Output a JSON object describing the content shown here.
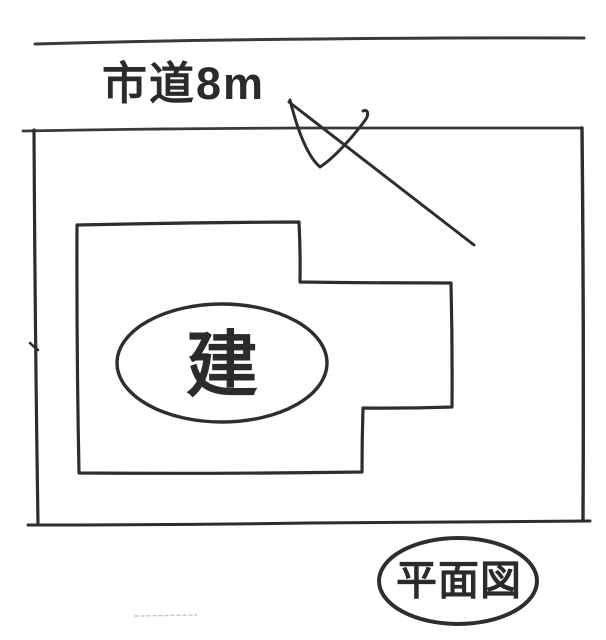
{
  "colors": {
    "paper": "#ffffff",
    "ink": "#2e2e2e",
    "ink_soft": "#3a3a3a",
    "artifact": "#c9c9c9"
  },
  "labels": {
    "road": "市道8m",
    "building": "建",
    "caption": "平面図"
  }
}
